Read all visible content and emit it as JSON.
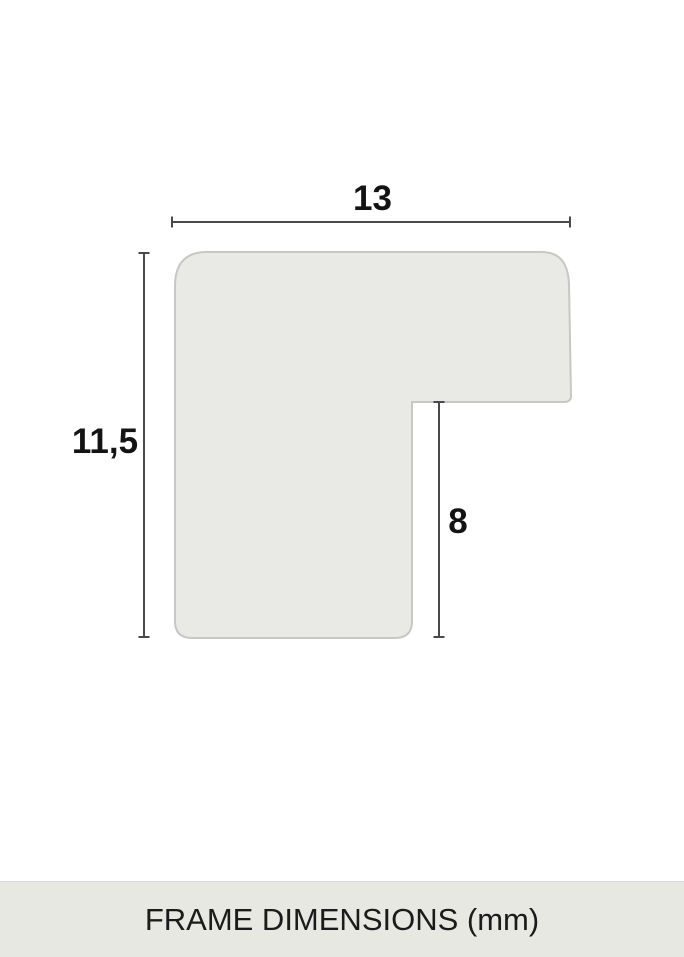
{
  "diagram": {
    "type": "frame-profile-cross-section",
    "labels": {
      "width": "13",
      "height": "11,5",
      "rabbet_depth": "8"
    },
    "measurements": {
      "width_mm": 13,
      "height_mm": 11.5,
      "rabbet_depth_mm": 8,
      "unit": "mm"
    },
    "colors": {
      "profile_fill": "#e9e9e5",
      "profile_stroke": "#c7c7c3",
      "dimension_line": "#4a4a4a",
      "label_text": "#131313"
    }
  },
  "footer": {
    "caption": "FRAME DIMENSIONS (mm)",
    "background": "#e8e8e3",
    "text_color": "#1b1b1b"
  }
}
